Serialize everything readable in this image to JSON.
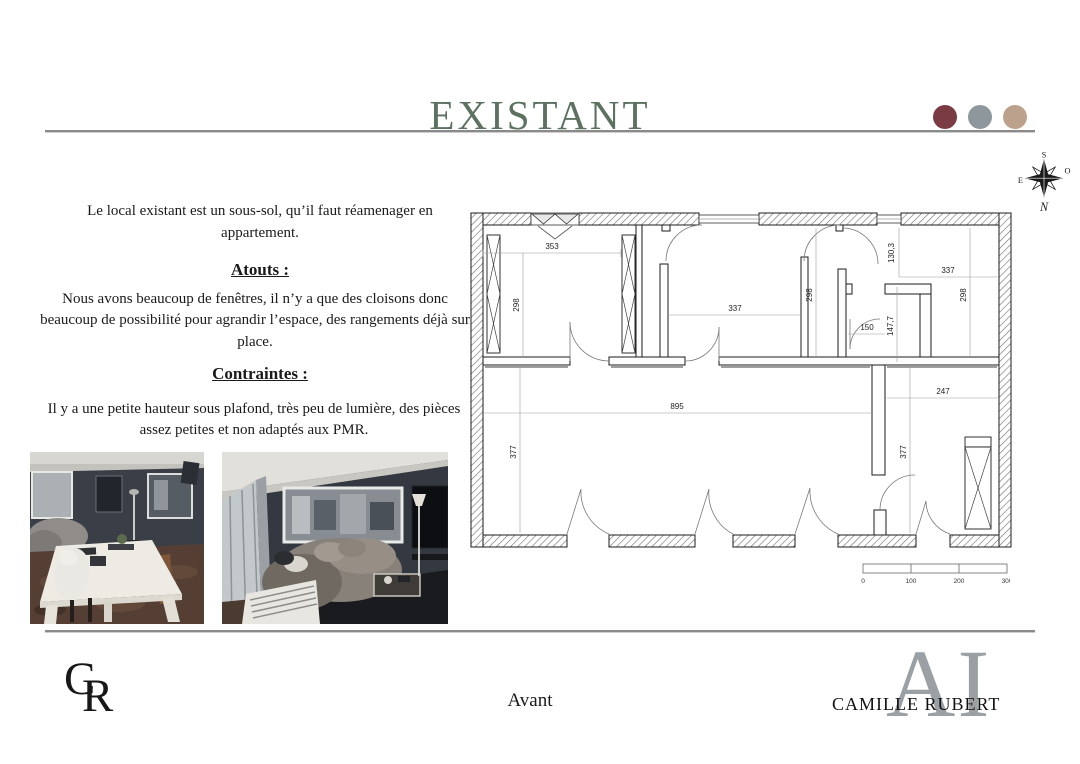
{
  "header": {
    "title": "EXISTANT",
    "title_color": "#5d7161",
    "palette_dots": [
      "#7b3b43",
      "#8e979c",
      "#bca28c"
    ],
    "dot_styles": [
      "background:#7b3b43",
      "background:#8e979c",
      "background:#bca28c"
    ]
  },
  "content": {
    "intro": "Le local existant est un sous-sol, qu’il faut réamenager en appartement.",
    "atouts_heading": "Atouts :",
    "atouts_body": "Nous avons beaucoup de fenêtres, il n’y a que des cloisons donc beaucoup de possibilité pour agrandir l’espace, des rangements déjà sur place.",
    "contraintes_heading": "Contraintes :",
    "contraintes_body": "Il y a une petite hauteur sous plafond, très peu de lumière, des pièces assez petites et non adaptés aux PMR."
  },
  "compass": {
    "n": "N",
    "s": "S",
    "e": "E",
    "o": "O"
  },
  "plan": {
    "dims": {
      "d353": "353",
      "d298_left": "298",
      "d337_mid": "337",
      "d298_mid": "298",
      "d130_3": "130,3",
      "d337_top_right": "337",
      "d298_right": "298",
      "d150": "150",
      "d147_7": "147,7",
      "d895": "895",
      "d377_left": "377",
      "d247": "247",
      "d377_right": "377"
    },
    "scale_bar": {
      "t0": "0",
      "t100": "100",
      "t200": "200",
      "t300": "300"
    }
  },
  "footer": {
    "monogram": {
      "c": "C",
      "r": "R"
    },
    "caption": "Avant",
    "brand": "CAMILLE RUBERT",
    "watermark": "AI"
  }
}
